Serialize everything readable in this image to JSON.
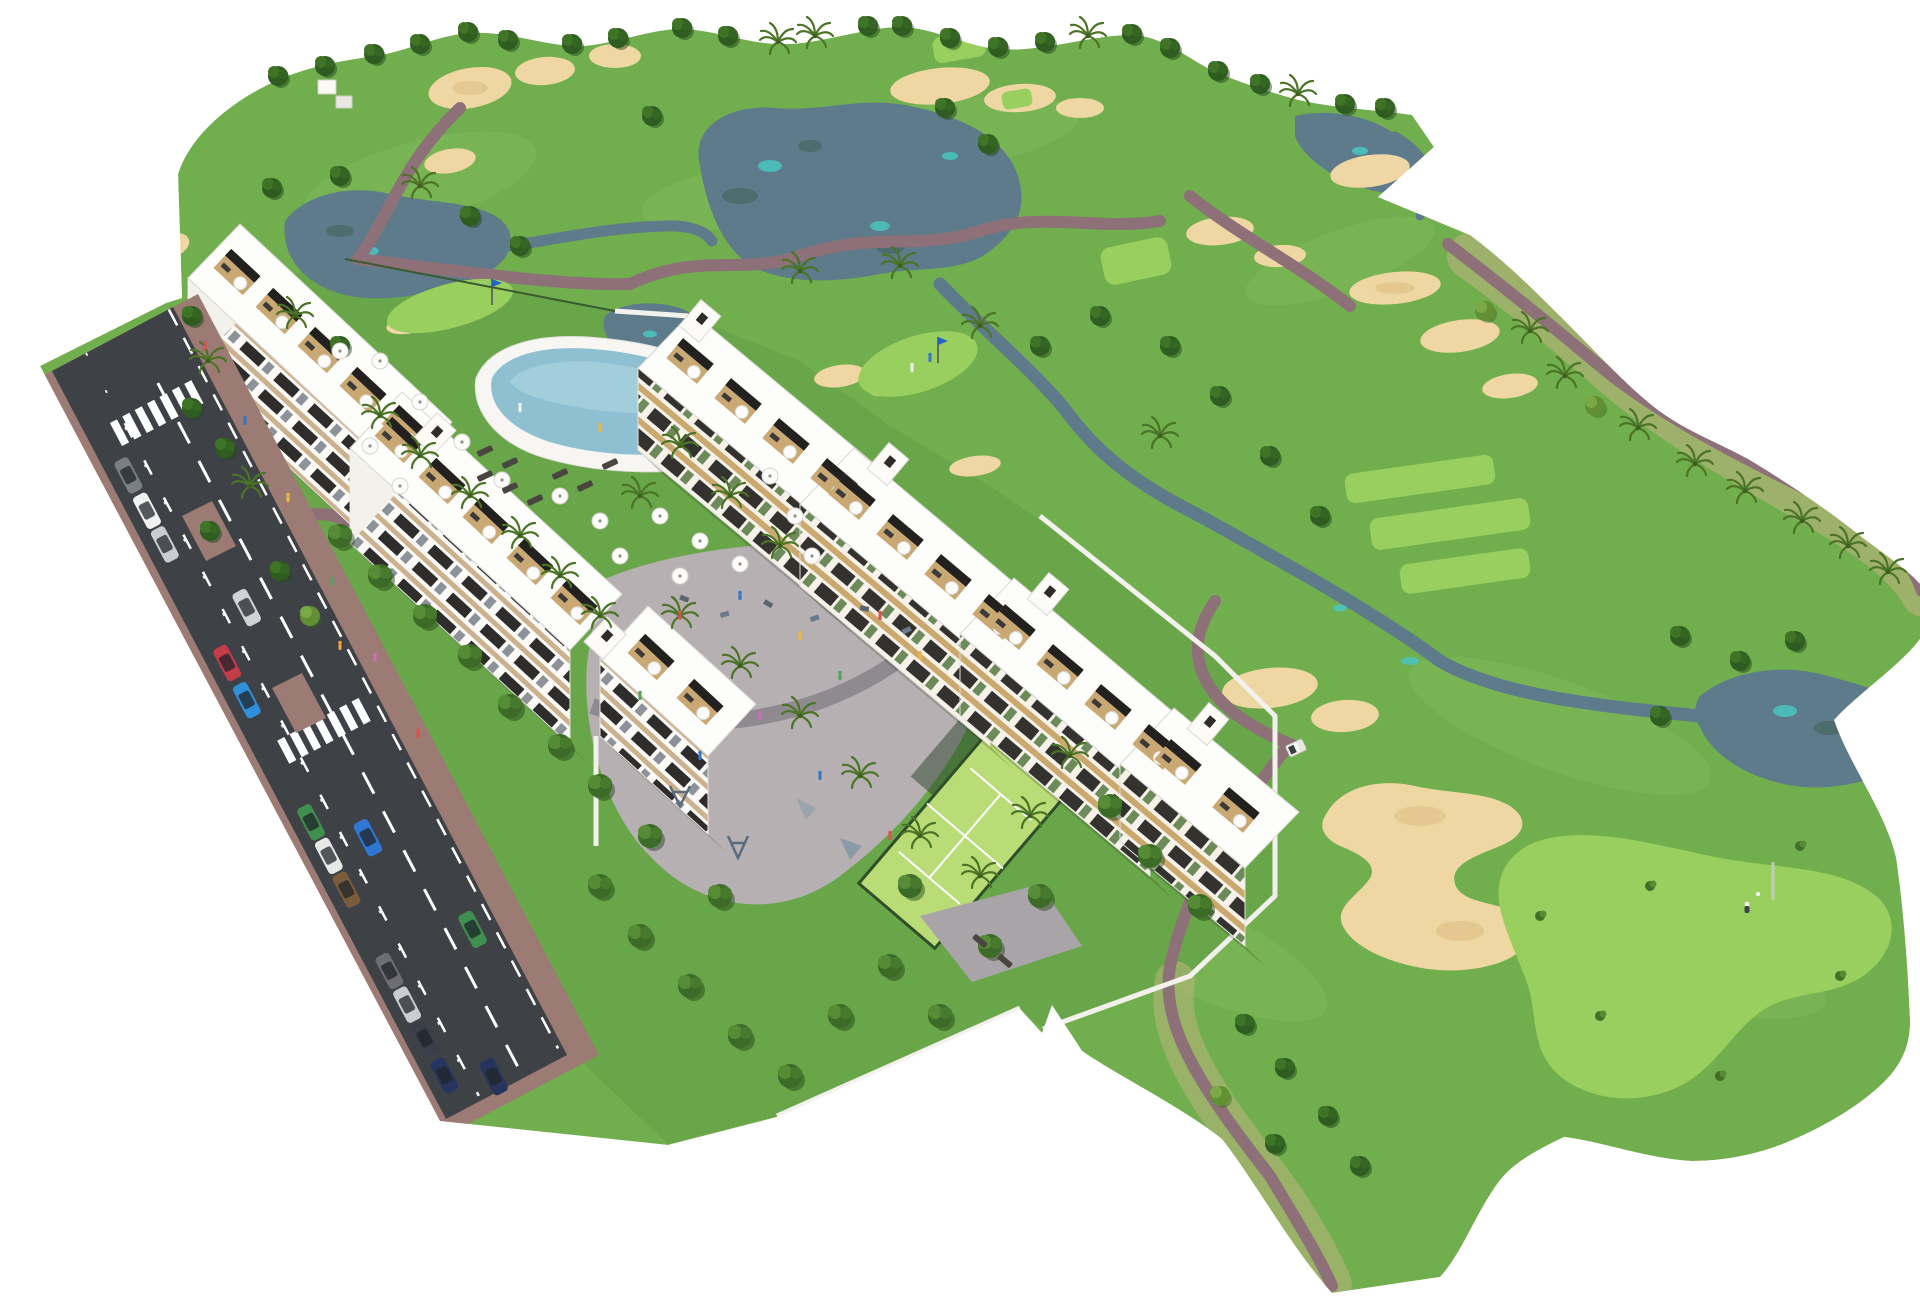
{
  "meta": {
    "title": "Aerial 3D masterplan render of a residential golf resort",
    "image_type": "architectural aerial rendering",
    "background": "#ffffff"
  },
  "palette": {
    "grass": "#71ae4e",
    "grass-light": "#98cf5e",
    "grass-site": "#69a64a",
    "grass-accent": "#7fbb58",
    "lake": "#5d7b8a",
    "teal": "#49c5c0",
    "sand": "#eed7a3",
    "sand-shade": "#e2c489",
    "scrub": "#c2b582",
    "path": "#8d7078",
    "asphalt": "#3e4146",
    "brick": "#9b7b74",
    "marking": "#ffffff",
    "wall": "#f2f1ec",
    "roof": "#fdfdfb",
    "terrace": "#c9a873",
    "pergola": "#1e1e1e",
    "beige": "#cbb18e",
    "window": "#2e2d2b",
    "padel": "#b9dc76",
    "padel-fence": "#2f4e2a",
    "plaza": "#b7b0b3",
    "plaza-walk": "#8f8a90",
    "pool": "#8fc0d2",
    "deck": "#f7f6f2",
    "tree-dark": "#2f5c20",
    "tree-light": "#628f33",
    "tree-lush": "#3c6b28",
    "palm": "#4c7427"
  },
  "scene": {
    "golf_course": {
      "lakes": 5,
      "streams": 3,
      "sand_bunkers": 20,
      "greens_with_flag": 3,
      "flag_colors": [
        "blue",
        "blue",
        "white"
      ],
      "tee_boxes": 6,
      "golf_cart": 1,
      "golfer_on_green": 1,
      "cart_paths": "mauve winding paths",
      "tree_types": [
        "round deciduous",
        "palms",
        "bushes"
      ]
    },
    "development": {
      "left_apartment_blocks": 3,
      "left_block_floors": 4,
      "center_townhouse_blocks": 4,
      "rooftop_terraces": "wood decks with black pergolas and white parasols",
      "swimming_pool": 1,
      "pool_umbrellas": 17,
      "sun_loungers": 10,
      "playground_plaza": 1,
      "padel_court": 1,
      "perimeter_wall_color": "white",
      "gardens": "walled gardens with lush trees"
    },
    "street": {
      "lanes": 2,
      "parking_lane": true,
      "parked_cars": 12,
      "moving_cars": 4,
      "crosswalks": 2,
      "sidewalk_material": "red brick pavers",
      "pedestrians": true
    }
  }
}
